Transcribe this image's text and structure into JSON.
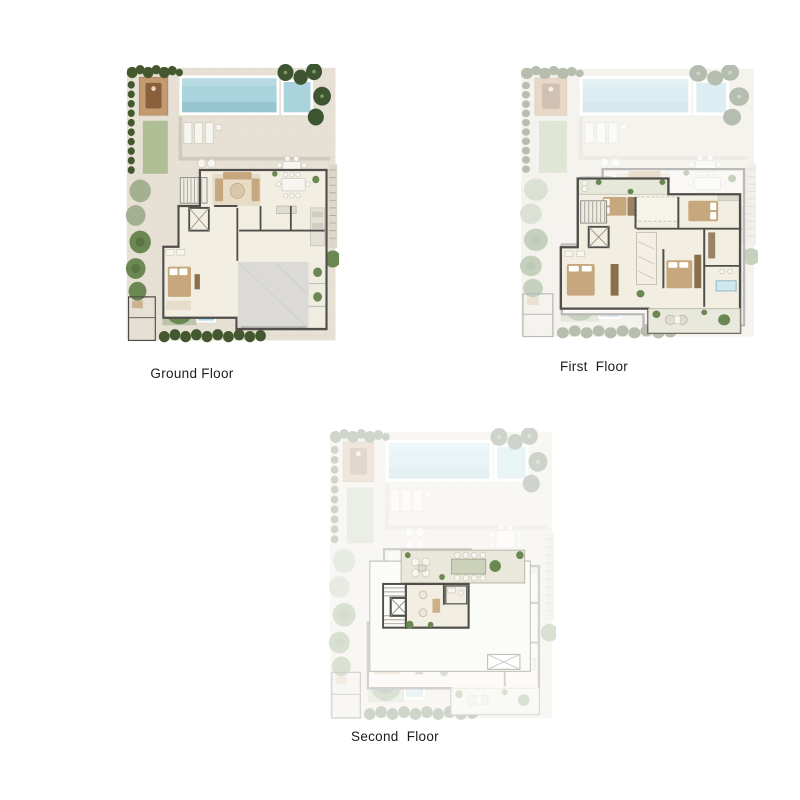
{
  "page": {
    "background": "#ffffff"
  },
  "plans": [
    {
      "id": "ground-floor",
      "label": "Ground Floor"
    },
    {
      "id": "first-floor",
      "label": "First  Floor"
    },
    {
      "id": "second-floor",
      "label": "Second  Floor"
    }
  ],
  "colors": {
    "paving": "#e6e1d4",
    "pavingLine": "#d6d0c2",
    "pool": "#a9d4dd",
    "poolDeep": "#7fb3c2",
    "lawn": "#afbe94",
    "hedge": "#44582f",
    "palm": "#3e5531",
    "tree": "#6b8852",
    "treePale": "#a3b191",
    "deck": "#c49b70",
    "deckDark": "#8a5f3c",
    "wall": "#4f4e4a",
    "floor": "#f3eee2",
    "garage": "#dbdad6",
    "wood": "#c7a87e",
    "woodDark": "#8a6f4d",
    "label": "#1c1c1c"
  }
}
